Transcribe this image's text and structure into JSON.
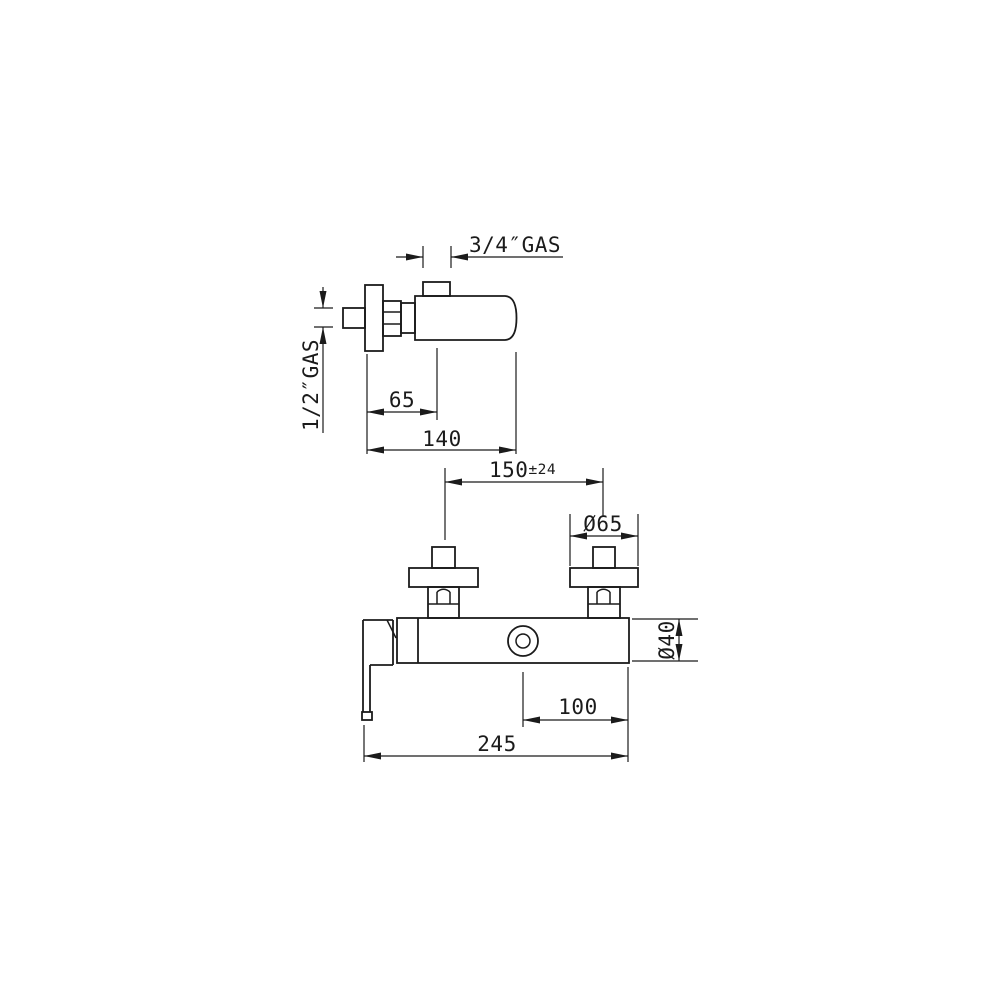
{
  "colors": {
    "line": "#1b1b1b",
    "background": "#ffffff"
  },
  "top_view": {
    "outlet_thread_label": "3/4″GAS",
    "inlet_thread_label": "1/2″GAS",
    "projection_depth": "65",
    "total_depth": "140"
  },
  "front_view": {
    "inlet_spacing": "150",
    "inlet_spacing_tolerance": "±24",
    "flange_diameter": "Ø65",
    "body_diameter": "Ø40",
    "outlet_offset": "100",
    "overall_width": "245"
  }
}
